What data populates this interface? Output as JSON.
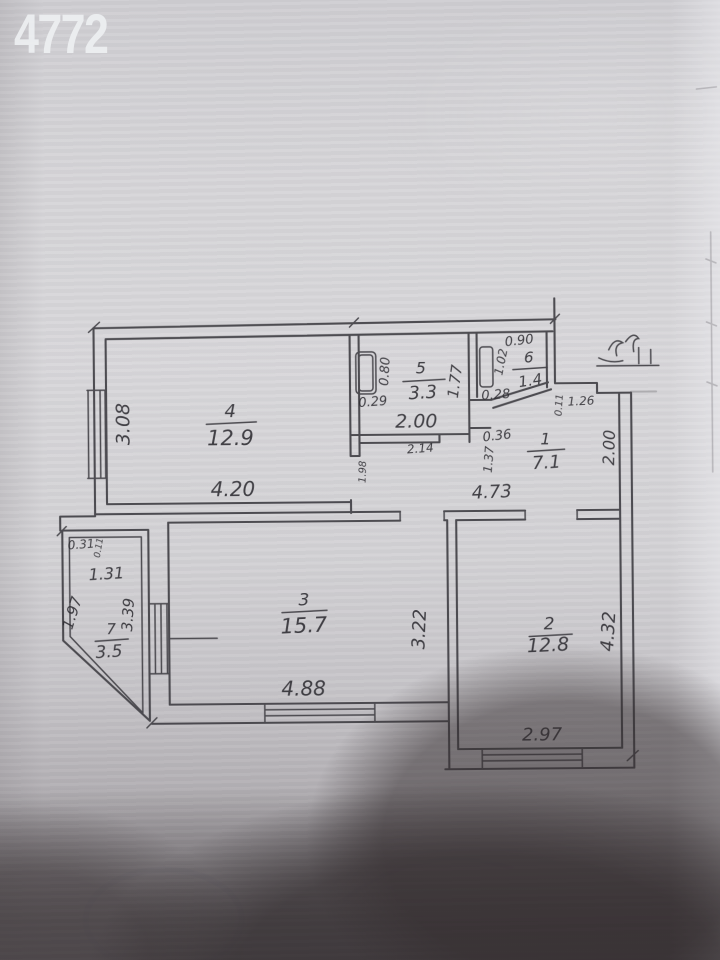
{
  "watermark": "4772",
  "plan": {
    "rooms": [
      {
        "number": "4",
        "area": "12.9"
      },
      {
        "number": "5",
        "area": "3.3"
      },
      {
        "number": "6",
        "area": "1.4"
      },
      {
        "number": "1",
        "area": "7.1"
      },
      {
        "number": "3",
        "area": "15.7"
      },
      {
        "number": "2",
        "area": "12.8"
      },
      {
        "number": "7",
        "area": "3.5"
      }
    ],
    "dims": {
      "room4_left": "3.08",
      "room4_bottom": "4.20",
      "room5_fixture_h": "0.80",
      "room5_fixture_w": "0.29",
      "room5_right": "1.77",
      "room5_bottom": "2.00",
      "room5_below": "2.14",
      "room6_top": "0.90",
      "room6_left": "1.02",
      "room6_fixture": "0.28",
      "room6_diag": "0.36",
      "hall_wall_small": "0.11",
      "hall_entry": "1.26",
      "hall_left": "1.37",
      "hall_right": "2.00",
      "hall_bottom": "4.73",
      "hall_door": "1.98",
      "room3_right": "3.22",
      "room3_bottom": "4.88",
      "room2_right": "4.32",
      "room2_bottom": "2.97",
      "room7_top_small": "0.31",
      "room7_top_tiny": "0.11",
      "room7_top": "1.31",
      "room7_diag": "1.97",
      "room7_right": "3.39"
    }
  }
}
